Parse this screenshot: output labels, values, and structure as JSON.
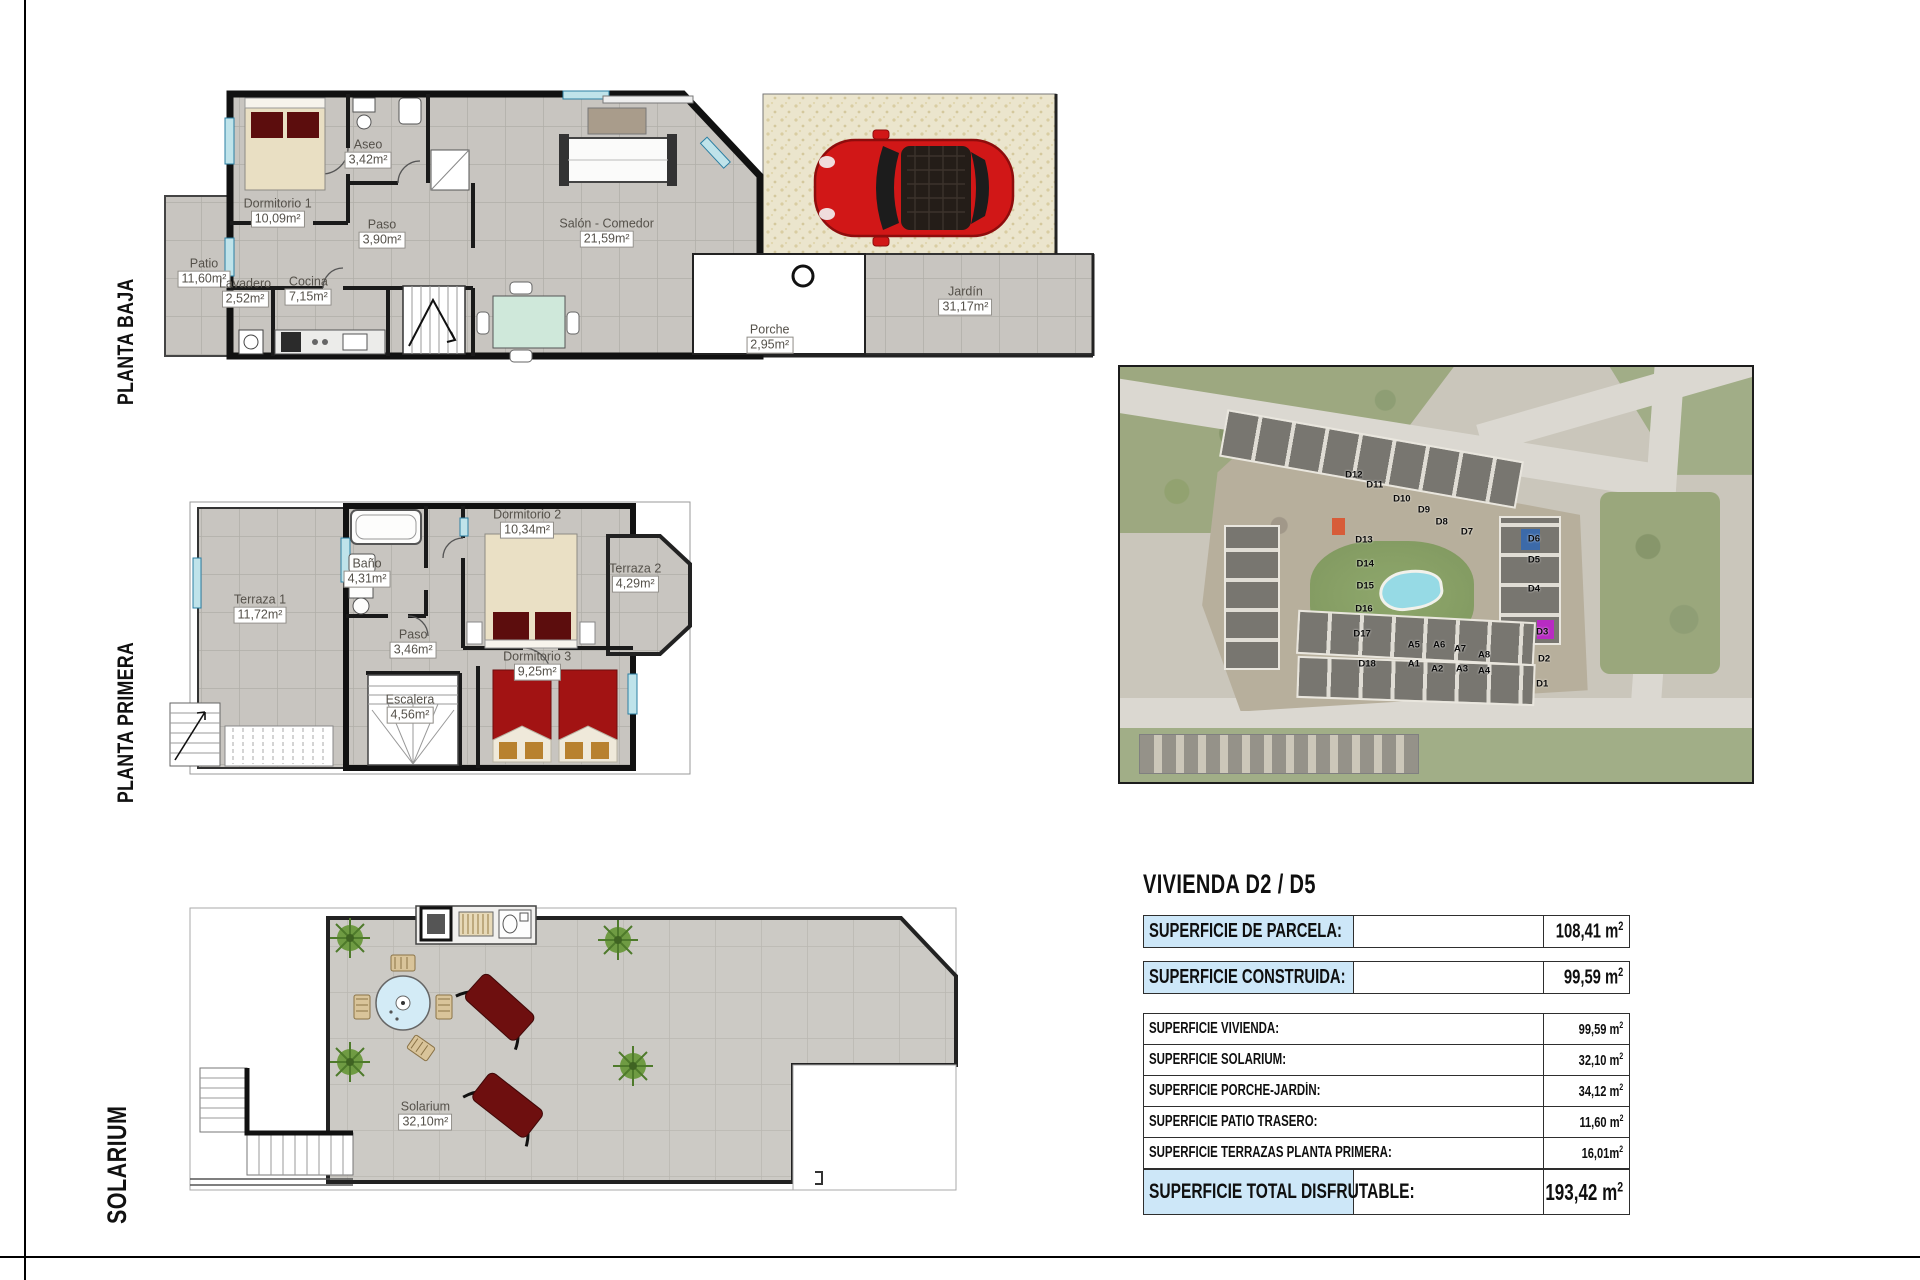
{
  "floors": {
    "planta_baja": {
      "label": "PLANTA BAJA",
      "rooms": [
        {
          "name": "Dormitorio 1",
          "area": "10,09m²",
          "x": 12.3,
          "y": 42.5
        },
        {
          "name": "Aseo",
          "area": "3,42m²",
          "x": 22.0,
          "y": 22.3
        },
        {
          "name": "Paso",
          "area": "3,90m²",
          "x": 23.5,
          "y": 49.7
        },
        {
          "name": "Salón - Comedor",
          "area": "21,59m²",
          "x": 47.6,
          "y": 49.3
        },
        {
          "name": "Patio",
          "area": "11,60m²",
          "x": 4.4,
          "y": 63.0
        },
        {
          "name": "Lavadero",
          "area": "2,52m²",
          "x": 8.8,
          "y": 69.9
        },
        {
          "name": "Cocina",
          "area": "7,15m²",
          "x": 15.6,
          "y": 69.2
        },
        {
          "name": "Porche",
          "area": "2,95m²",
          "x": 65.1,
          "y": 85.6
        },
        {
          "name": "Jardín",
          "area": "31,17m²",
          "x": 86.1,
          "y": 72.6
        }
      ]
    },
    "planta_primera": {
      "label": "PLANTA PRIMERA",
      "rooms": [
        {
          "name": "Terraza 1",
          "area": "11,72m²",
          "x": 18.3,
          "y": 39.3
        },
        {
          "name": "Baño",
          "area": "4,31m²",
          "x": 38.5,
          "y": 26.4
        },
        {
          "name": "Dormitorio 2",
          "area": "10,34m²",
          "x": 68.7,
          "y": 8.9
        },
        {
          "name": "Terraza 2",
          "area": "4,29m²",
          "x": 89.1,
          "y": 28.2
        },
        {
          "name": "Paso",
          "area": "3,46m²",
          "x": 47.2,
          "y": 51.8
        },
        {
          "name": "Dormitorio 3",
          "area": "9,25m²",
          "x": 70.6,
          "y": 59.6
        },
        {
          "name": "Escalera",
          "area": "4,56m²",
          "x": 46.6,
          "y": 75.0
        }
      ]
    },
    "solarium": {
      "label": "SOLARIUM",
      "rooms": [
        {
          "name": "Solarium",
          "area": "32,10m²",
          "x": 32.8,
          "y": 72.9
        }
      ]
    }
  },
  "site_map": {
    "units": [
      {
        "id": "D12",
        "x": 37.0,
        "y": 26.0
      },
      {
        "id": "D11",
        "x": 40.3,
        "y": 28.4
      },
      {
        "id": "D10",
        "x": 44.6,
        "y": 31.8
      },
      {
        "id": "D9",
        "x": 48.1,
        "y": 34.5
      },
      {
        "id": "D8",
        "x": 50.9,
        "y": 37.3
      },
      {
        "id": "D7",
        "x": 54.9,
        "y": 39.8
      },
      {
        "id": "D13",
        "x": 38.6,
        "y": 41.7
      },
      {
        "id": "D14",
        "x": 38.8,
        "y": 47.5
      },
      {
        "id": "D15",
        "x": 38.8,
        "y": 52.8
      },
      {
        "id": "D16",
        "x": 38.6,
        "y": 58.3
      },
      {
        "id": "D17",
        "x": 38.3,
        "y": 64.3
      },
      {
        "id": "D18",
        "x": 39.1,
        "y": 71.6
      },
      {
        "id": "D6",
        "x": 65.5,
        "y": 41.4
      },
      {
        "id": "D5",
        "x": 65.5,
        "y": 46.5
      },
      {
        "id": "D4",
        "x": 65.5,
        "y": 53.5
      },
      {
        "id": "A5",
        "x": 46.5,
        "y": 67.0
      },
      {
        "id": "A6",
        "x": 50.5,
        "y": 67.0
      },
      {
        "id": "A7",
        "x": 53.8,
        "y": 68.0
      },
      {
        "id": "A8",
        "x": 57.6,
        "y": 69.4
      },
      {
        "id": "A1",
        "x": 46.5,
        "y": 71.6
      },
      {
        "id": "A2",
        "x": 50.2,
        "y": 72.8
      },
      {
        "id": "A3",
        "x": 54.1,
        "y": 72.8
      },
      {
        "id": "A4",
        "x": 57.6,
        "y": 73.3
      },
      {
        "id": "D3",
        "x": 66.8,
        "y": 63.9
      },
      {
        "id": "D2",
        "x": 67.1,
        "y": 70.4
      },
      {
        "id": "D1",
        "x": 66.8,
        "y": 76.4
      }
    ]
  },
  "summary": {
    "title": "VIVIENDA D2 / D5",
    "rows_big": [
      {
        "label": "SUPERFICIE DE PARCELA:",
        "value": "108,41 m",
        "sup": "2"
      },
      {
        "label": "SUPERFICIE CONSTRUIDA:",
        "value": "99,59 m",
        "sup": "2"
      }
    ],
    "detail_rows": [
      {
        "label": "SUPERFICIE VIVIENDA:",
        "value": "99,59 m",
        "sup": "2"
      },
      {
        "label": "SUPERFICIE SOLARIUM:",
        "value": "32,10 m",
        "sup": "2"
      },
      {
        "label": "SUPERFICIE PORCHE-JARDÍN:",
        "value": "34,12 m",
        "sup": "2"
      },
      {
        "label": "SUPERFICIE PATIO TRASERO:",
        "value": "11,60 m",
        "sup": "2"
      },
      {
        "label": "SUPERFICIE TERRAZAS PLANTA PRIMERA:",
        "value": "16,01m",
        "sup": "2"
      }
    ],
    "total_row": {
      "label": "SUPERFICIE TOTAL DISFRUTABLE:",
      "value": "193,42 m",
      "sup": "2"
    }
  },
  "colors": {
    "highlight_blue": "#cde7f8",
    "car_red": "#d11717",
    "pool_blue": "#8ed8e4",
    "accent_purple": "#b31bbf",
    "accent_orange": "#d4502a"
  }
}
